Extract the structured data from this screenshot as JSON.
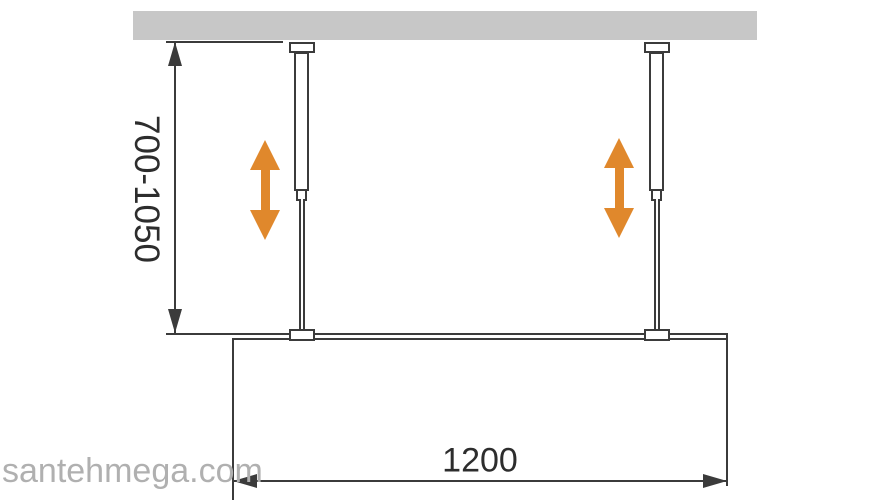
{
  "diagram": {
    "labels": {
      "height_range": "700-1050",
      "width": "1200"
    },
    "watermark": "santehmega.com",
    "icons": {
      "height_dimension_top": "arrowhead-up-icon",
      "height_dimension_bottom": "arrowhead-down-icon",
      "width_dimension_left": "arrowhead-left-icon",
      "width_dimension_right": "arrowhead-right-icon",
      "adjustability": "vertical-double-arrow-icon"
    },
    "colors": {
      "line": "#3b3b3b",
      "text": "#2d2d2d",
      "ceiling": "#c7c7c7",
      "accent-orange": "#e0882c",
      "watermark": "#b0b0b0",
      "background": "#ffffff"
    }
  }
}
